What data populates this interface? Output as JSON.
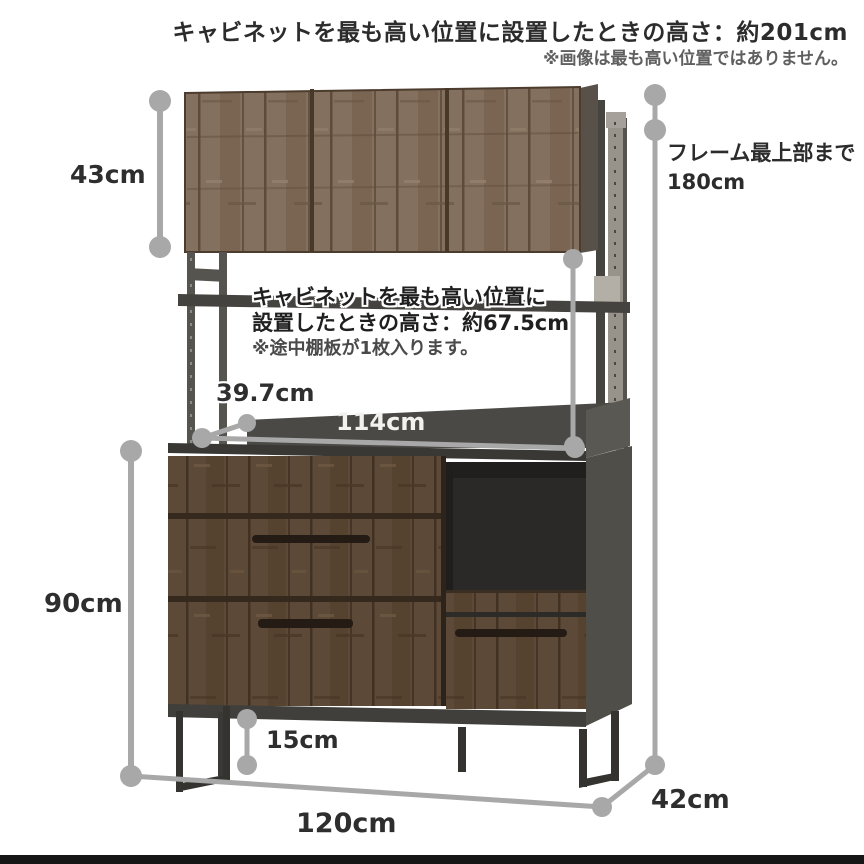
{
  "page": {
    "type": "product-dimension-diagram",
    "background": "#ffffff",
    "bottom_bar_color": "#161616"
  },
  "annotations": {
    "top_heading": "キャビネットを最も高い位置に設置したときの高さ：約201cm",
    "top_note": "※画像は最も高い位置ではありません。",
    "frame_top_label": "フレーム最上部まで",
    "frame_top_value": "180cm",
    "mid_block": {
      "line1": "キャビネットを最も高い位置に",
      "line2": "設置したときの高さ：約67.5cm",
      "note": "※途中棚板が1枚入ります。"
    }
  },
  "dimensions": {
    "upper_cabinet_height": "43cm",
    "counter_shelf_depth": "39.7cm",
    "inner_counter_width": "114cm",
    "lower_cabinet_height": "90cm",
    "leg_clearance_height": "15cm",
    "overall_width": "120cm",
    "overall_depth": "42cm",
    "frame_top_height": "180cm",
    "max_cabinet_position_height": "約201cm",
    "max_open_space_height": "約67.5cm"
  },
  "colors": {
    "dimension_line": "#a8a8a8",
    "text_dark": "#2e2e2e",
    "wood_light_base": "#84705e",
    "wood_dark_base": "#5c4836",
    "metal_frame": "#34332f",
    "counter_panel": "#4b4945",
    "side_panel": "#504e49"
  }
}
